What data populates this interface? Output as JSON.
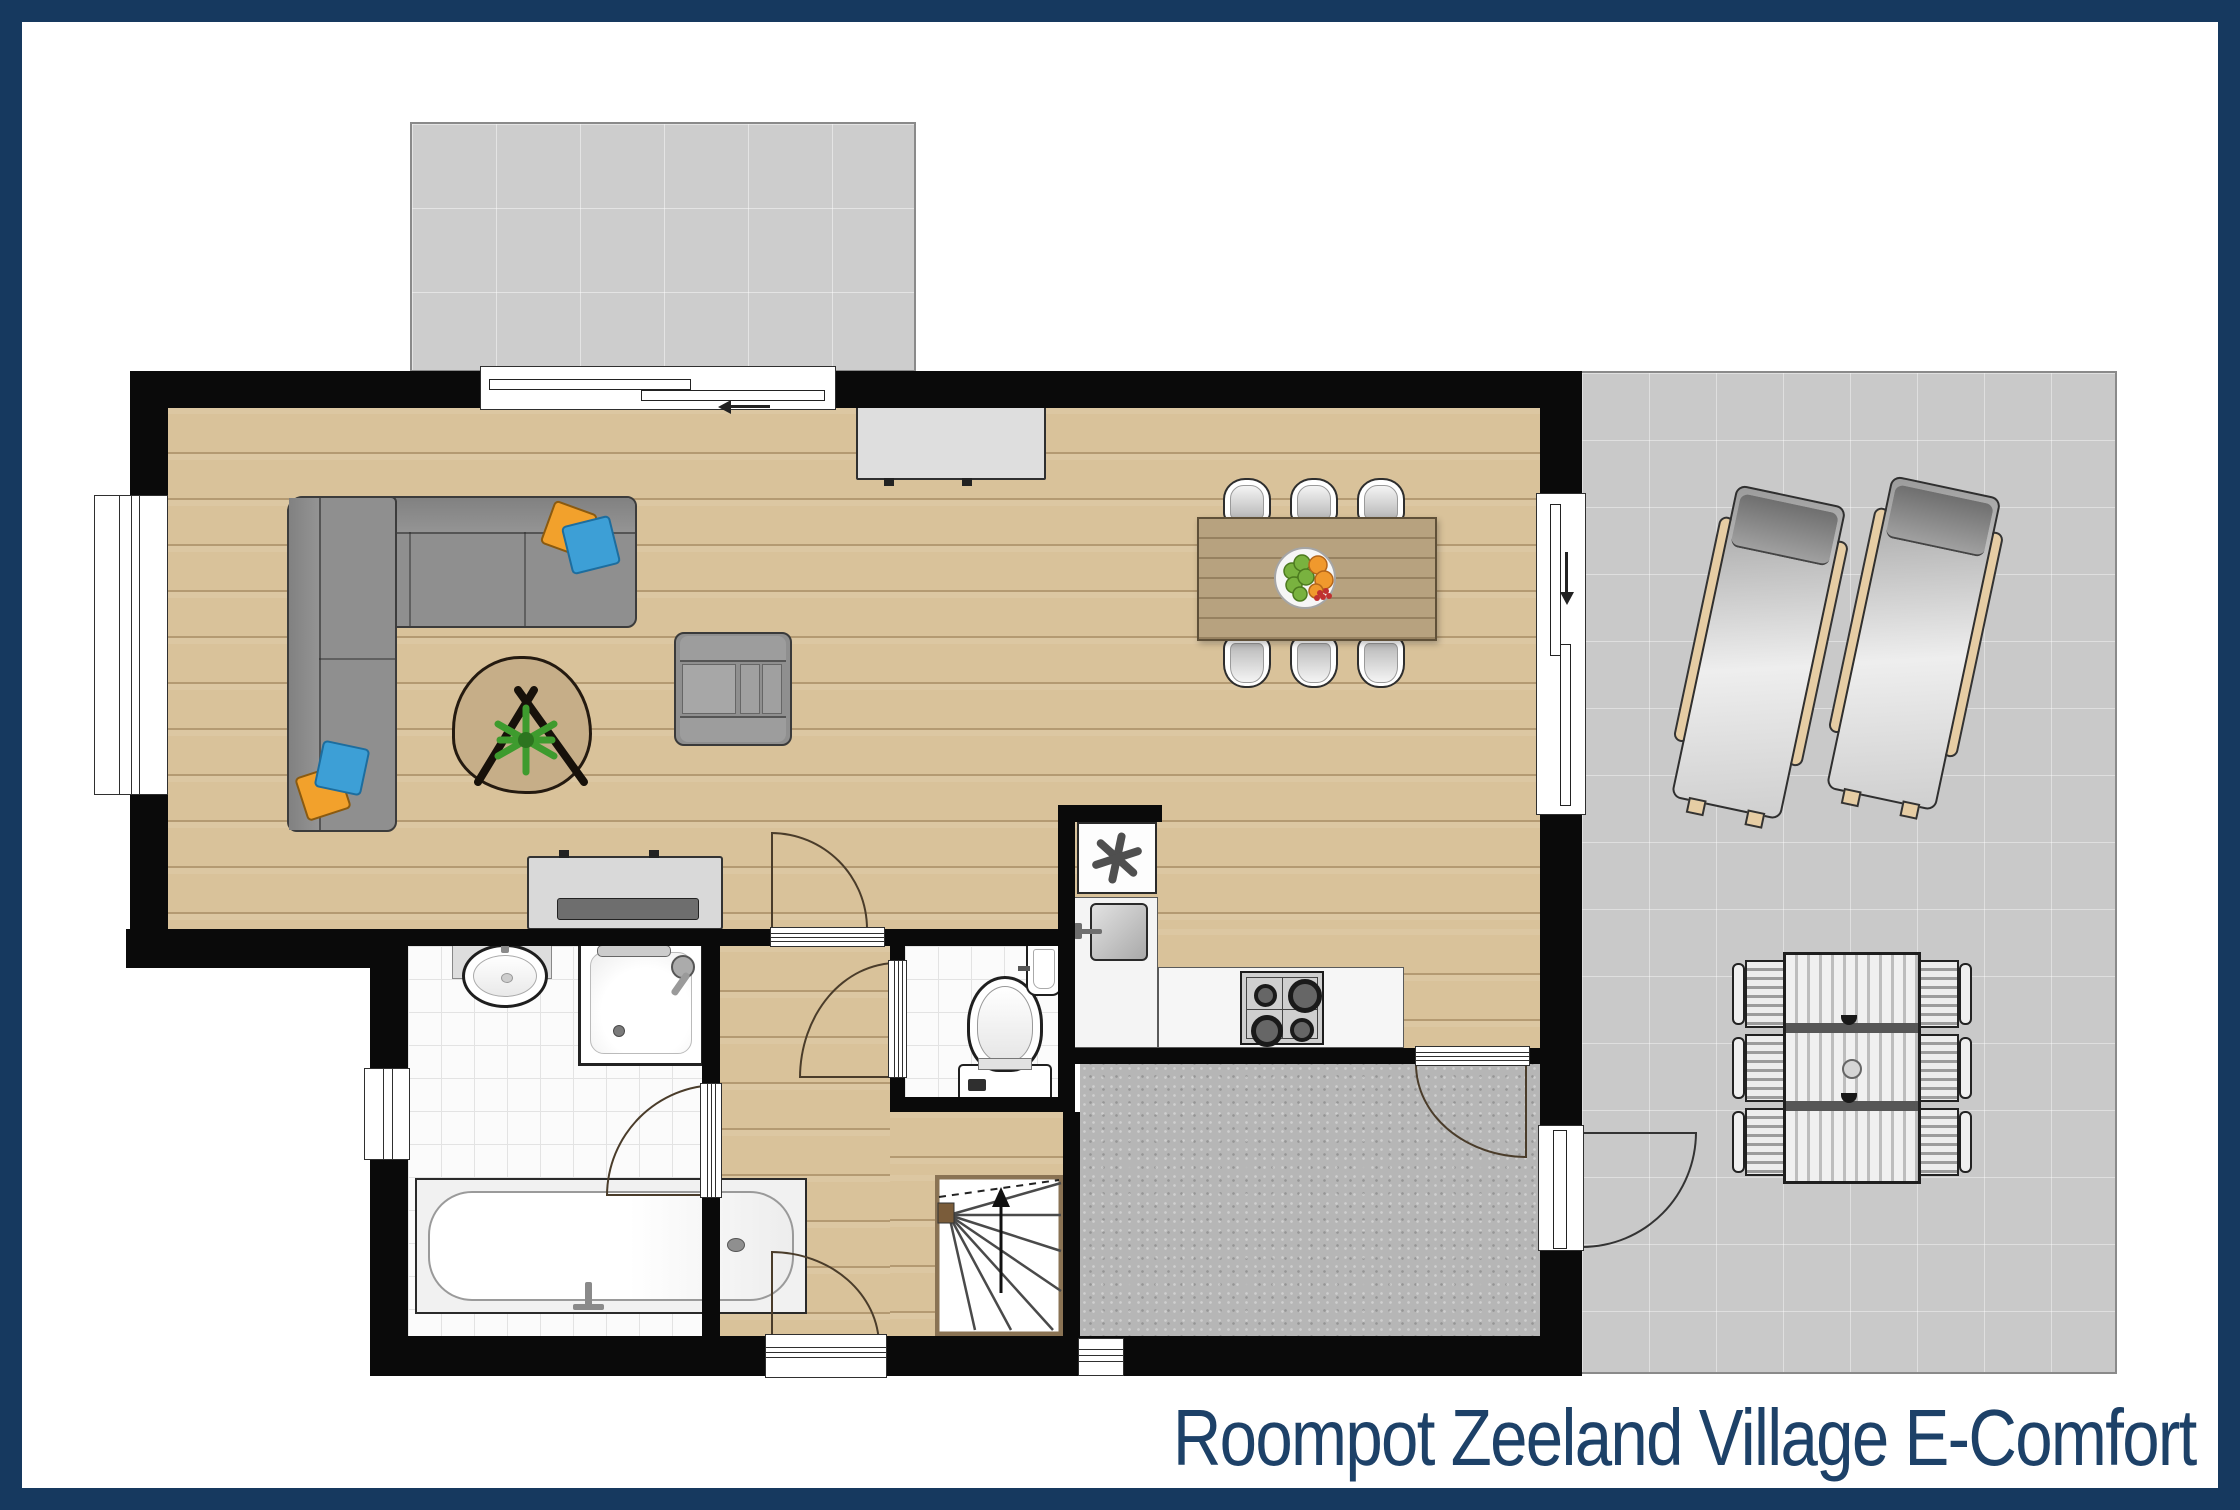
{
  "title": {
    "text": "Roompot Zeeland Village E-Comfort"
  },
  "symbols": {
    "freezer-icon": "✳",
    "slider-arrow-left-icon": "←",
    "slider-arrow-down-icon": "↓",
    "stairs-up-arrow-icon": "↑"
  },
  "colors": {
    "frame_navy": "#16395f",
    "title_navy": "#1d4168",
    "wall_black": "#0a0a0a",
    "wood_floor": "#d9c29a",
    "tile_floor": "#fbfbfb",
    "terrace_gray": "#c9c9c9",
    "patio_gray": "#cdcdcd",
    "entrance_gray": "#b6b6b6",
    "sofa_gray": "#8f8f8f",
    "cushion_orange": "#f2a12c",
    "cushion_blue": "#3d9fd6",
    "plant_green": "#3e9b2e",
    "dining_table_wood": "#b7a27f",
    "lounger_wood": "#e6cda4"
  }
}
